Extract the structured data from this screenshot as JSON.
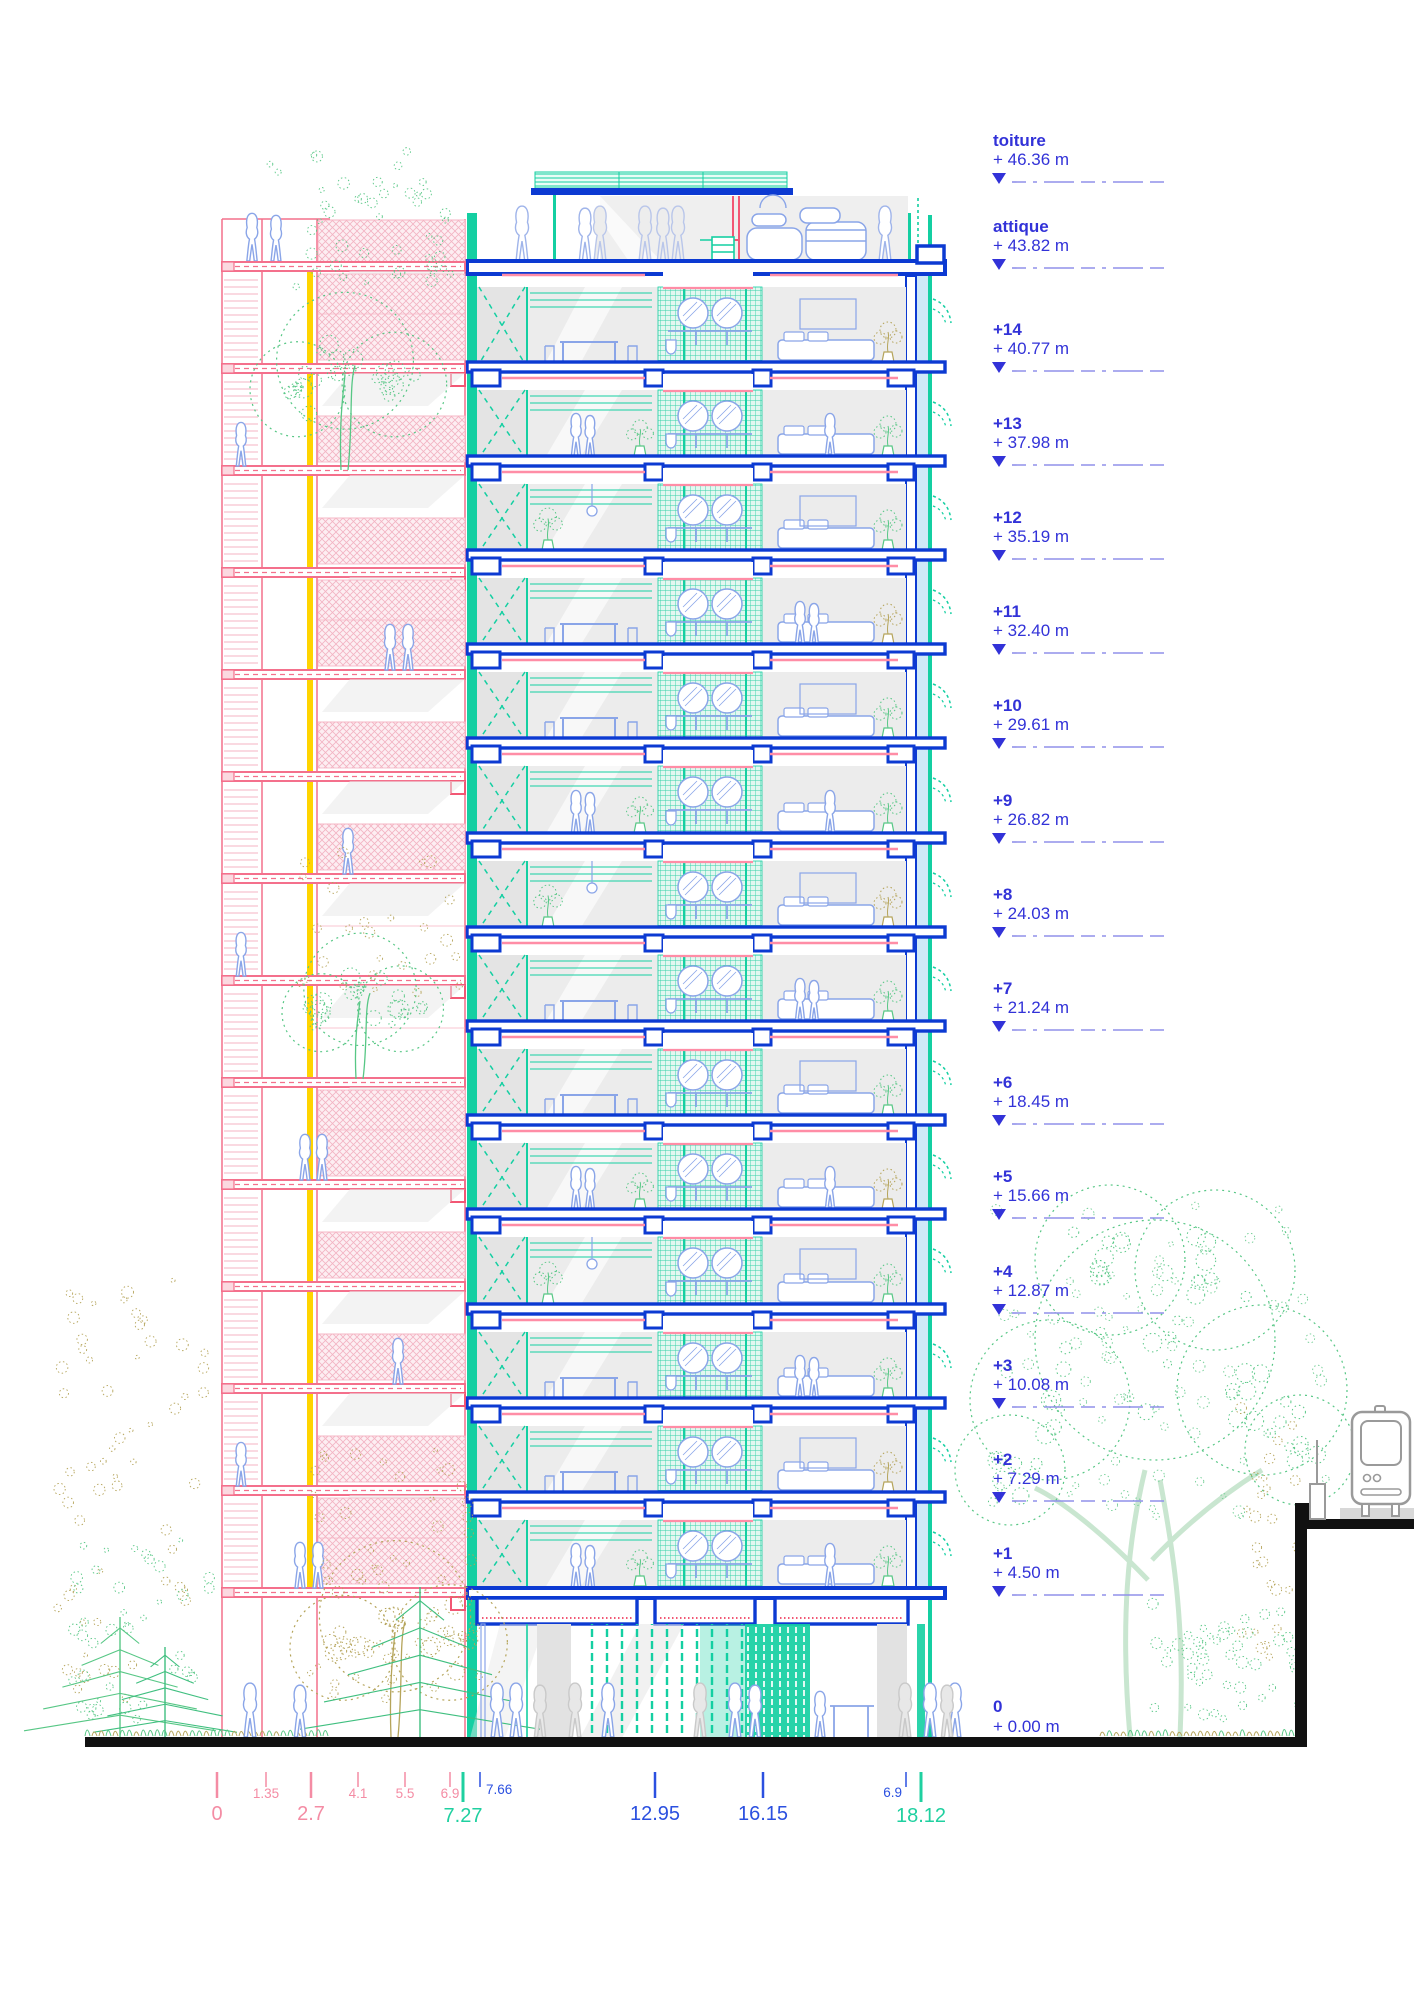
{
  "drawing": {
    "kind": "building cross-section"
  },
  "colors": {
    "structure_blue": "#0c3ad2",
    "teal": "#14cfa2",
    "teal_dark": "#00b98e",
    "pink": "#f4708c",
    "pink_light": "#f6b3c3",
    "pink_fill": "#fdeef2",
    "yellow": "#ffd400",
    "glazing_blue": "#cfe9f8",
    "label_blue": "#3232d8",
    "dash_blue": "#9090ea",
    "furniture_blue": "#8aa5e8",
    "dim_pink": "#f48ca4",
    "dim_green": "#1fd0a0",
    "dim_blue": "#2b50e0",
    "plant_green": "#57c785",
    "plant_light": "#8fd3a8",
    "plant_olive": "#b5a45a",
    "ground_black": "#111111",
    "interior_gray": "#ececec",
    "device_gray": "#9a9a9a"
  },
  "levels": [
    {
      "name": "toiture",
      "elevation_label": "+ 46.36 m",
      "meters": 46.36
    },
    {
      "name": "attique",
      "elevation_label": "+ 43.82 m",
      "meters": 43.82
    },
    {
      "name": "+14",
      "elevation_label": "+ 40.77 m",
      "meters": 40.77
    },
    {
      "name": "+13",
      "elevation_label": "+ 37.98 m",
      "meters": 37.98
    },
    {
      "name": "+12",
      "elevation_label": "+ 35.19 m",
      "meters": 35.19
    },
    {
      "name": "+11",
      "elevation_label": "+ 32.40 m",
      "meters": 32.4
    },
    {
      "name": "+10",
      "elevation_label": "+ 29.61 m",
      "meters": 29.61
    },
    {
      "name": "+9",
      "elevation_label": "+ 26.82 m",
      "meters": 26.82
    },
    {
      "name": "+8",
      "elevation_label": "+ 24.03 m",
      "meters": 24.03
    },
    {
      "name": "+7",
      "elevation_label": "+ 21.24 m",
      "meters": 21.24
    },
    {
      "name": "+6",
      "elevation_label": "+ 18.45 m",
      "meters": 18.45
    },
    {
      "name": "+5",
      "elevation_label": "+ 15.66 m",
      "meters": 15.66
    },
    {
      "name": "+4",
      "elevation_label": "+ 12.87 m",
      "meters": 12.87
    },
    {
      "name": "+3",
      "elevation_label": "+ 10.08 m",
      "meters": 10.08
    },
    {
      "name": "+2",
      "elevation_label": "+ 7.29 m",
      "meters": 7.29
    },
    {
      "name": "+1",
      "elevation_label": "+ 4.50 m",
      "meters": 4.5
    },
    {
      "name": "0",
      "elevation_label": "+ 0.00 m",
      "meters": 0.0
    }
  ],
  "dimensions": [
    {
      "value": "0",
      "color": "pink",
      "size": "large"
    },
    {
      "value": "1.35",
      "color": "pink",
      "size": "small"
    },
    {
      "value": "2.7",
      "color": "pink",
      "size": "large"
    },
    {
      "value": "4.1",
      "color": "pink",
      "size": "small"
    },
    {
      "value": "5.5",
      "color": "pink",
      "size": "small"
    },
    {
      "value": "6.9",
      "color": "pink",
      "size": "small"
    },
    {
      "value": "7.27",
      "color": "green",
      "size": "large"
    },
    {
      "value": "7.66",
      "color": "blue",
      "size": "small"
    },
    {
      "value": "12.95",
      "color": "blue",
      "size": "large"
    },
    {
      "value": "16.15",
      "color": "blue",
      "size": "large"
    },
    {
      "value": "6.9",
      "color": "blue",
      "size": "small"
    },
    {
      "value": "18.12",
      "color": "green",
      "size": "large"
    }
  ]
}
